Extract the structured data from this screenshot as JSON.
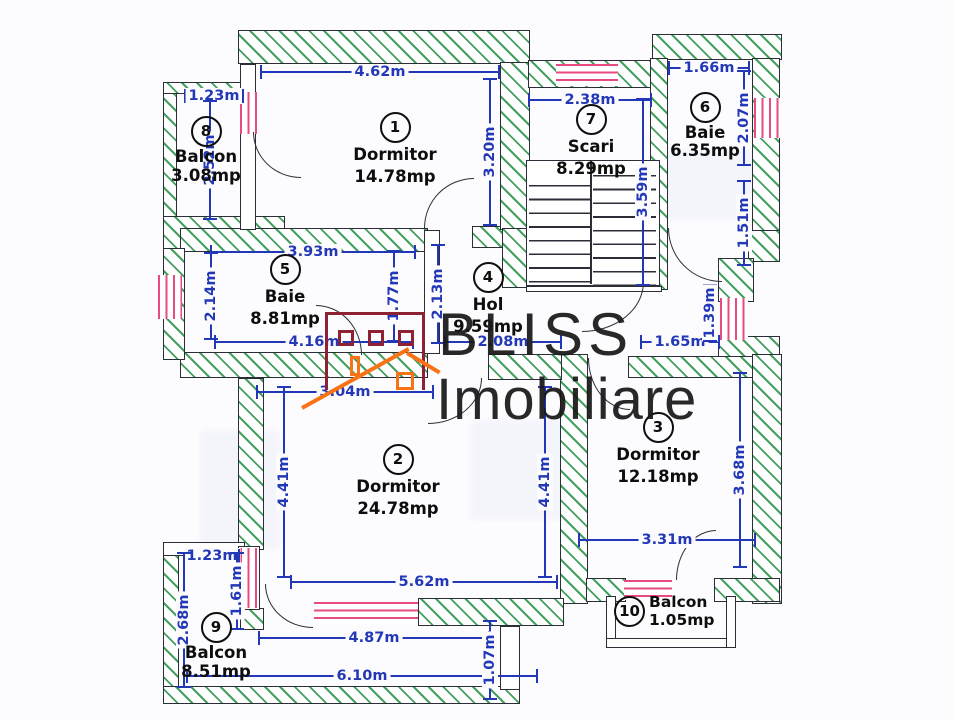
{
  "watermark": {
    "brand_line1": "BLISS",
    "brand_line2": "Imobiliare"
  },
  "rooms": [
    {
      "num": "1",
      "name": "Dormitor",
      "area": "14.78mp"
    },
    {
      "num": "2",
      "name": "Dormitor",
      "area": "24.78mp"
    },
    {
      "num": "3",
      "name": "Dormitor",
      "area": "12.18mp"
    },
    {
      "num": "4",
      "name": "Hol",
      "area": "9.59mp"
    },
    {
      "num": "5",
      "name": "Baie",
      "area": "8.81mp"
    },
    {
      "num": "6",
      "name": "Baie",
      "area": "6.35mp"
    },
    {
      "num": "7",
      "name": "Scari",
      "area": "8.29mp"
    },
    {
      "num": "8",
      "name": "Balcon",
      "area": "3.08mp"
    },
    {
      "num": "9",
      "name": "Balcon",
      "area": "8.51mp"
    },
    {
      "num": "10",
      "name": "Balcon",
      "area": "1.05mp"
    }
  ],
  "dims": {
    "room1_width": "4.62m",
    "balcon8_width": "1.23m",
    "balcon8_height": "2.52m",
    "room1_height": "3.20m",
    "scari_width": "2.38m",
    "scari_height": "3.59m",
    "baie6_width": "1.66m",
    "baie6_height_upper": "2.07m",
    "baie6_height_lower": "1.51m",
    "baie5_width_top": "3.93m",
    "baie5_height_left": "2.14m",
    "baie5_width_bottom": "4.16m",
    "baie5_height_right": "1.77m",
    "hol_height": "2.13m",
    "hol_width": "2.08m",
    "window_right_width": "1.65m",
    "window_right_height": "1.39m",
    "room2_width_top": "3.04m",
    "room2_height_left": "4.41m",
    "room2_height_right": "4.41m",
    "room2_width_bottom": "5.62m",
    "room3_height": "3.68m",
    "room3_width": "3.31m",
    "balcon9_width_top": "1.23m",
    "balcon9_height_left": "2.68m",
    "balcon9_height_inner": "1.61m",
    "balcon9_width_mid": "4.87m",
    "balcon9_width_bottom": "6.10m",
    "balcon9_height_right": "1.07m"
  },
  "colors": {
    "dimension_blue": "#2338b6",
    "wall_hatch_green": "#43a05e",
    "window_pink": "#e74b82",
    "wall_outline": "#2d2d38",
    "watermark_maroon": "#8e2132",
    "watermark_orange": "#f97316"
  }
}
